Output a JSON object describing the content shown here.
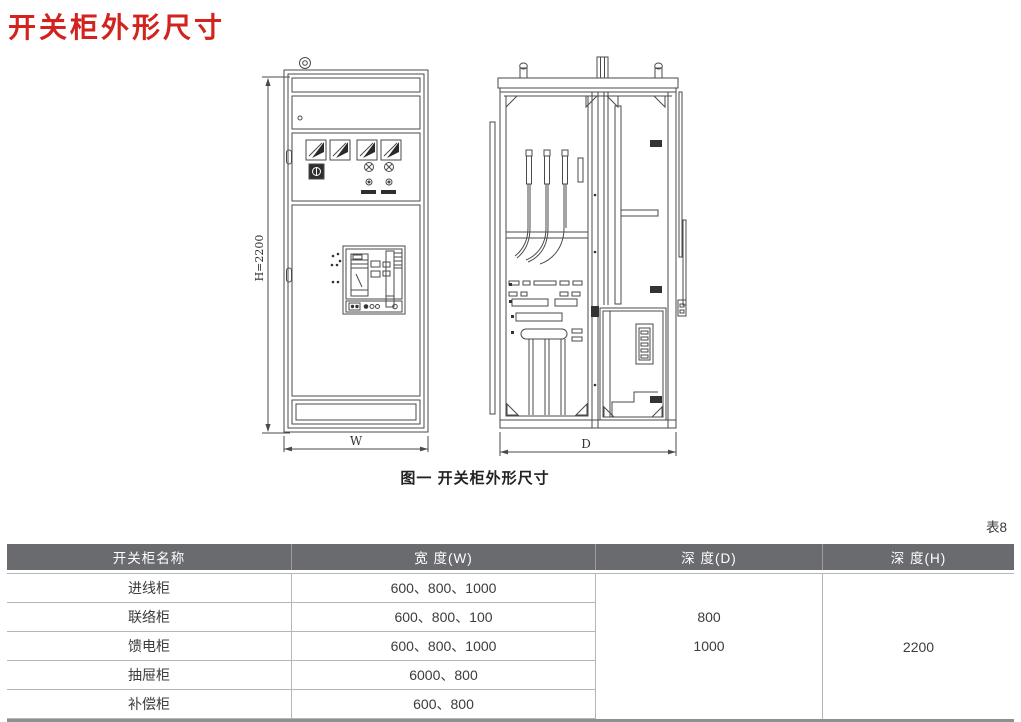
{
  "page": {
    "title": "开关柜外形尺寸"
  },
  "colors": {
    "title_accent": "#d2231f",
    "table_header_bg": "#6a6b6e",
    "table_header_text": "#ffffff",
    "drawing_line": "#4a4a4a"
  },
  "figure": {
    "caption": "图一  开关柜外形尺寸",
    "front_view": {
      "height_label": "H=2200",
      "width_label": "W"
    },
    "side_view": {
      "depth_label": "D"
    }
  },
  "table": {
    "tag": "表8",
    "columns": [
      "开关柜名称",
      "宽 度(W)",
      "深 度(D)",
      "深 度(H)"
    ],
    "rows": [
      {
        "name": "进线柜",
        "width": "600、800、1000"
      },
      {
        "name": "联络柜",
        "width": "600、800、100"
      },
      {
        "name": "馈电柜",
        "width": "600、800、1000"
      },
      {
        "name": "抽屉柜",
        "width": "6000、800"
      },
      {
        "name": "补偿柜",
        "width": "600、800"
      }
    ],
    "depth_d": [
      "800",
      "1000"
    ],
    "depth_h": "2200"
  }
}
